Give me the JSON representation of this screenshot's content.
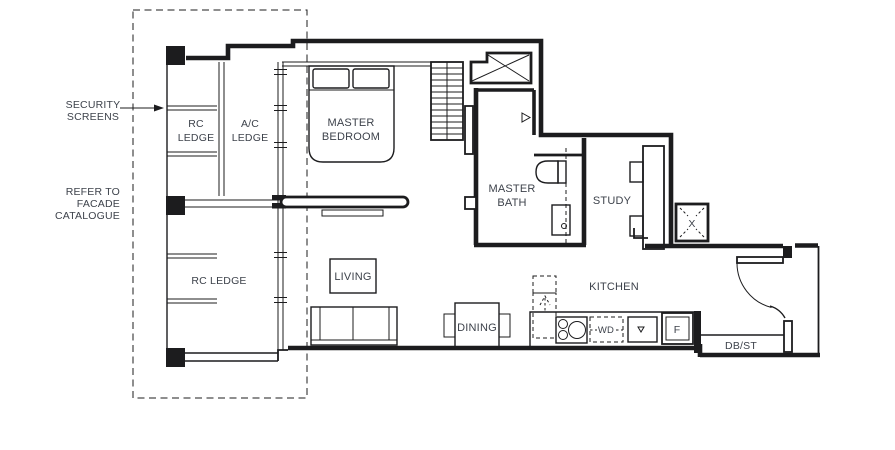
{
  "colors": {
    "line": "#1c1c1e",
    "text": "#3d424b",
    "background": "#ffffff"
  },
  "annotations": {
    "security_screens": {
      "line1": "SECURITY",
      "line2": "SCREENS"
    },
    "facade_note": {
      "line1": "REFER TO",
      "line2": "FACADE",
      "line3": "CATALOGUE"
    }
  },
  "areas": {
    "rc_ledge_top": {
      "line1": "RC",
      "line2": "LEDGE"
    },
    "ac_ledge": {
      "line1": "A/C",
      "line2": "LEDGE"
    },
    "master_bedroom": {
      "line1": "MASTER",
      "line2": "BEDROOM"
    },
    "master_bath": {
      "line1": "MASTER",
      "line2": "BATH"
    },
    "study": {
      "label": "STUDY"
    },
    "living": {
      "label": "LIVING"
    },
    "dining": {
      "label": "DINING"
    },
    "kitchen": {
      "label": "KITCHEN"
    },
    "rc_ledge_bottom": {
      "label": "RC LEDGE"
    }
  },
  "fixtures": {
    "washer_dryer": "WD",
    "fridge": "F",
    "db_store": "DB/ST",
    "ac_unit": "X"
  }
}
